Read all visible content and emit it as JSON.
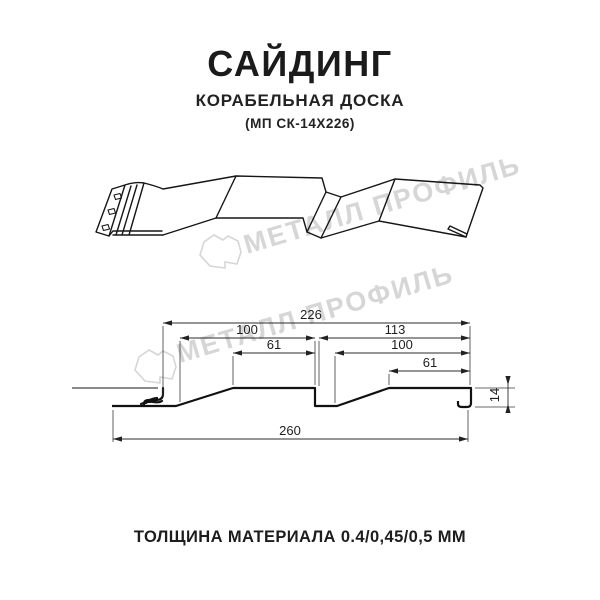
{
  "header": {
    "title": "САЙДИНГ",
    "subtitle": "КОРАБЕЛЬНАЯ ДОСКА",
    "model": "(МП СК-14Х226)"
  },
  "footer": {
    "thickness_note": "ТОЛЩИНА МАТЕРИАЛА 0.4/0,45/0,5 ММ"
  },
  "watermark": {
    "text": "МЕТАЛЛ ПРОФИЛЬ",
    "color": "#d6d6d6"
  },
  "colors": {
    "line": "#161616",
    "dimension": "#2b2b2b",
    "background": "#ffffff"
  },
  "dims": {
    "overall": "226",
    "left_module": "100",
    "right_module": "113",
    "left_top": "61",
    "right_inner": "100",
    "right_top": "61",
    "full_width": "260",
    "height": "14"
  }
}
